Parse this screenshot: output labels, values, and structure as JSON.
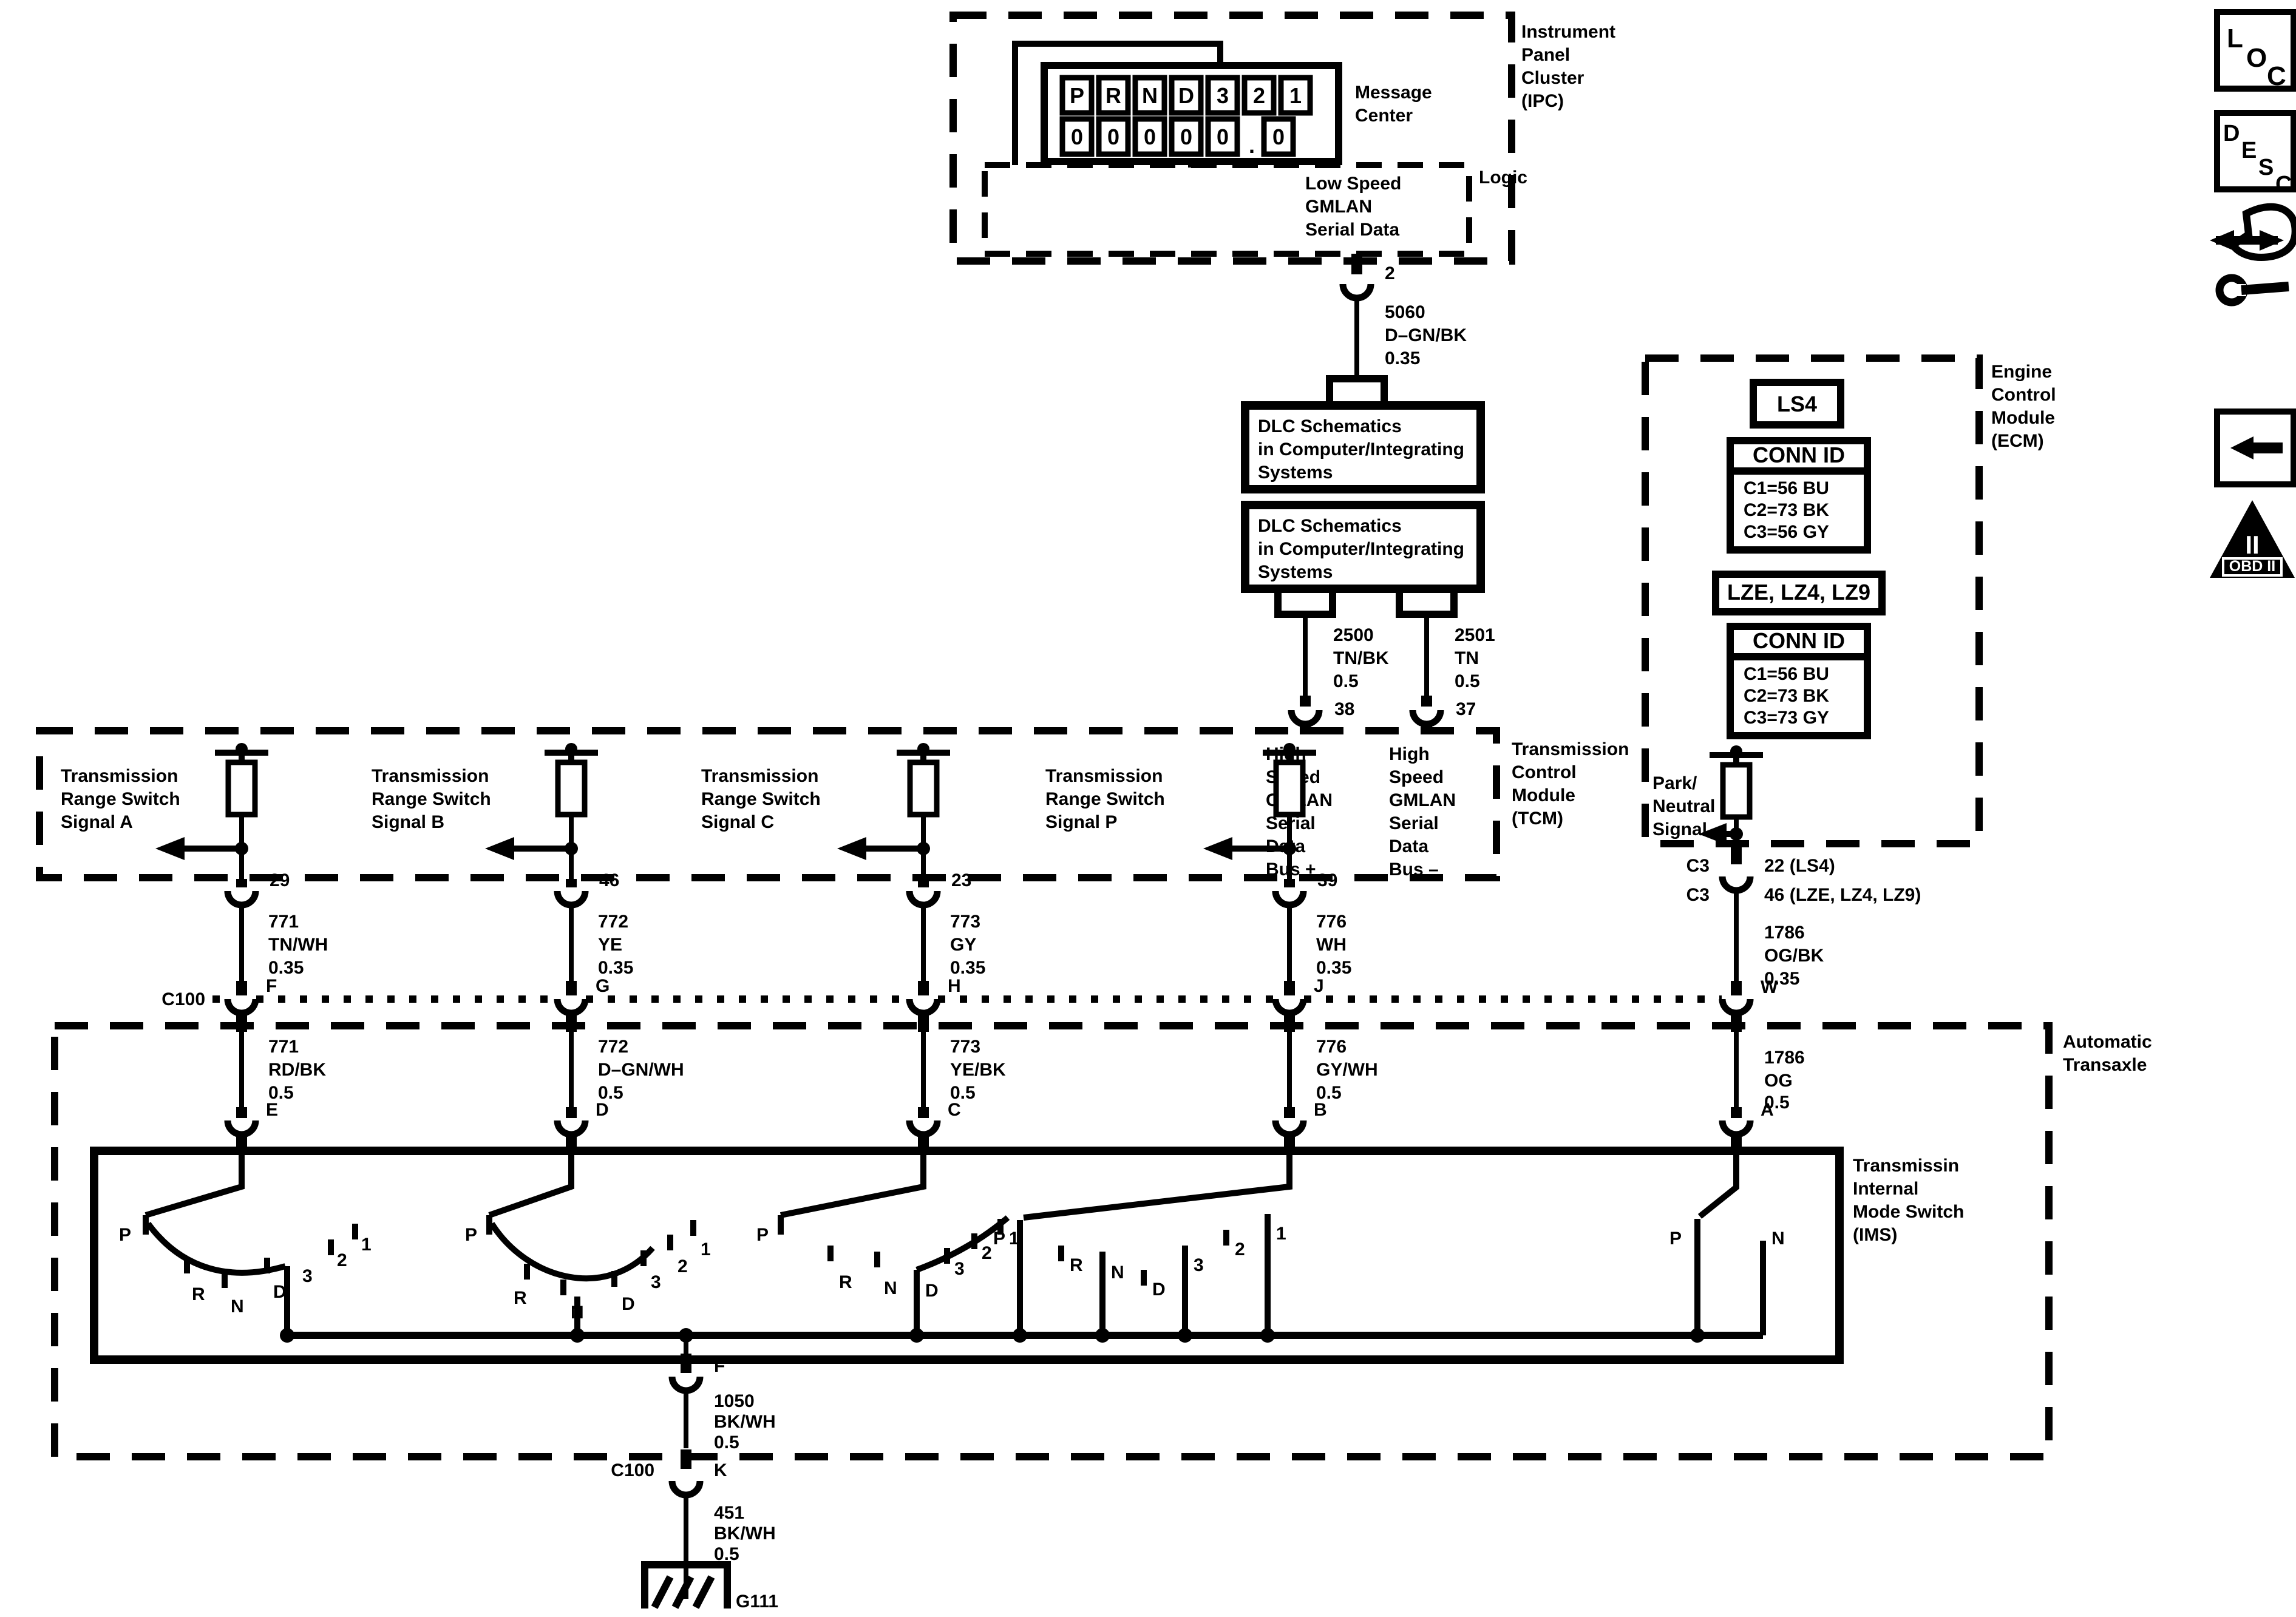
{
  "colors": {
    "ink": "#000000",
    "paper": "#ffffff"
  },
  "sidebar": {
    "loc_letters": [
      "L",
      "O",
      "C"
    ],
    "desc_letters": [
      "D",
      "E",
      "S",
      "C"
    ],
    "obd_numeral": "II",
    "obd_label": "OBD II"
  },
  "ipc": {
    "label_lines": [
      "Instrument",
      "Panel",
      "Cluster",
      "(IPC)"
    ],
    "message_center": {
      "label_lines": [
        "Message",
        "Center"
      ],
      "gear_row": [
        "P",
        "R",
        "N",
        "D",
        "3",
        "2",
        "1"
      ],
      "digit_row": [
        "0",
        "0",
        "0",
        "0",
        "0",
        "0"
      ],
      "decimal_point": "."
    },
    "logic": {
      "label": "Logic",
      "bus_lines": [
        "Low Speed",
        "GMLAN",
        "Serial Data"
      ]
    },
    "output": {
      "pin": "2",
      "circuit": "5060",
      "color": "D–GN/BK",
      "gauge": "0.35"
    }
  },
  "dlc": {
    "box1_lines": [
      "DLC Schematics",
      "in Computer/Integrating",
      "Systems"
    ],
    "box2_lines": [
      "DLC Schematics",
      "in Computer/Integrating",
      "Systems"
    ]
  },
  "gmlan": [
    {
      "circuit": "2500",
      "color": "TN/BK",
      "gauge": "0.5",
      "pin": "38",
      "bus_lines": [
        "High",
        "Speed",
        "GMLAN",
        "Serial",
        "Data",
        "Bus +"
      ]
    },
    {
      "circuit": "2501",
      "color": "TN",
      "gauge": "0.5",
      "pin": "37",
      "bus_lines": [
        "High",
        "Speed",
        "GMLAN",
        "Serial",
        "Data",
        "Bus –"
      ]
    }
  ],
  "tcm": {
    "label_lines": [
      "Transmission",
      "Control",
      "Module",
      "(TCM)"
    ]
  },
  "signals": [
    {
      "label_lines": [
        "Transmission",
        "Range Switch",
        "Signal A"
      ],
      "tcm_pin": "29",
      "upper": {
        "circuit": "771",
        "color": "TN/WH",
        "gauge": "0.35"
      },
      "c100_pin": "F",
      "lower": {
        "circuit": "771",
        "color": "RD/BK",
        "gauge": "0.5"
      },
      "ims_pin": "E"
    },
    {
      "label_lines": [
        "Transmission",
        "Range Switch",
        "Signal B"
      ],
      "tcm_pin": "46",
      "upper": {
        "circuit": "772",
        "color": "YE",
        "gauge": "0.35"
      },
      "c100_pin": "G",
      "lower": {
        "circuit": "772",
        "color": "D–GN/WH",
        "gauge": "0.5"
      },
      "ims_pin": "D"
    },
    {
      "label_lines": [
        "Transmission",
        "Range Switch",
        "Signal C"
      ],
      "tcm_pin": "23",
      "upper": {
        "circuit": "773",
        "color": "GY",
        "gauge": "0.35"
      },
      "c100_pin": "H",
      "lower": {
        "circuit": "773",
        "color": "YE/BK",
        "gauge": "0.5"
      },
      "ims_pin": "C"
    },
    {
      "label_lines": [
        "Transmission",
        "Range Switch",
        "Signal P"
      ],
      "tcm_pin": "39",
      "upper": {
        "circuit": "776",
        "color": "WH",
        "gauge": "0.35"
      },
      "c100_pin": "J",
      "lower": {
        "circuit": "776",
        "color": "GY/WH",
        "gauge": "0.5"
      },
      "ims_pin": "B"
    }
  ],
  "ecm": {
    "label_lines": [
      "Engine",
      "Control",
      "Module",
      "(ECM)"
    ],
    "engine1": "LS4",
    "conn_id_label": "CONN ID",
    "conn1_lines": [
      "C1=56 BU",
      "C2=73 BK",
      "C3=56 GY"
    ],
    "engine2": "LZE, LZ4, LZ9",
    "conn2_lines": [
      "C1=56 BU",
      "C2=73 BK",
      "C3=73 GY"
    ],
    "pn_label_lines": [
      "Park/",
      "Neutral",
      "Signal"
    ],
    "out_rows": [
      {
        "conn": "C3",
        "pin": "22 (LS4)"
      },
      {
        "conn": "C3",
        "pin": "46 (LZE, LZ4, LZ9)"
      }
    ],
    "upper": {
      "circuit": "1786",
      "color": "OG/BK",
      "gauge": "0.35"
    },
    "c100_pin": "W",
    "lower": {
      "circuit": "1786",
      "color": "OG",
      "gauge": "0.5"
    },
    "ims_pin": "A"
  },
  "c100": {
    "label": "C100"
  },
  "transaxle": {
    "label_lines": [
      "Automatic",
      "Transaxle"
    ]
  },
  "ims": {
    "label_lines": [
      "Transmissin",
      "Internal",
      "Mode Switch",
      "(IMS)"
    ],
    "switch_a": {
      "positions": [
        "P",
        "R",
        "N",
        "D",
        "3",
        "2",
        "1"
      ]
    },
    "switch_b": {
      "positions": [
        "P",
        "R",
        "N",
        "D",
        "3",
        "2",
        "1"
      ]
    },
    "switch_c": {
      "positions": [
        "P",
        "R",
        "N",
        "D",
        "3",
        "2",
        "1"
      ]
    },
    "switch_p": {
      "positions": [
        "P",
        "R",
        "N",
        "D",
        "3",
        "2",
        "1"
      ]
    },
    "switch_pn": {
      "positions": [
        "P",
        "N"
      ]
    }
  },
  "ground_path": {
    "ims_out_pin": "F",
    "upper": {
      "circuit": "1050",
      "color": "BK/WH",
      "gauge": "0.5"
    },
    "c100_pin": "K",
    "lower": {
      "circuit": "451",
      "color": "BK/WH",
      "gauge": "0.5"
    },
    "ground_id": "G111"
  }
}
